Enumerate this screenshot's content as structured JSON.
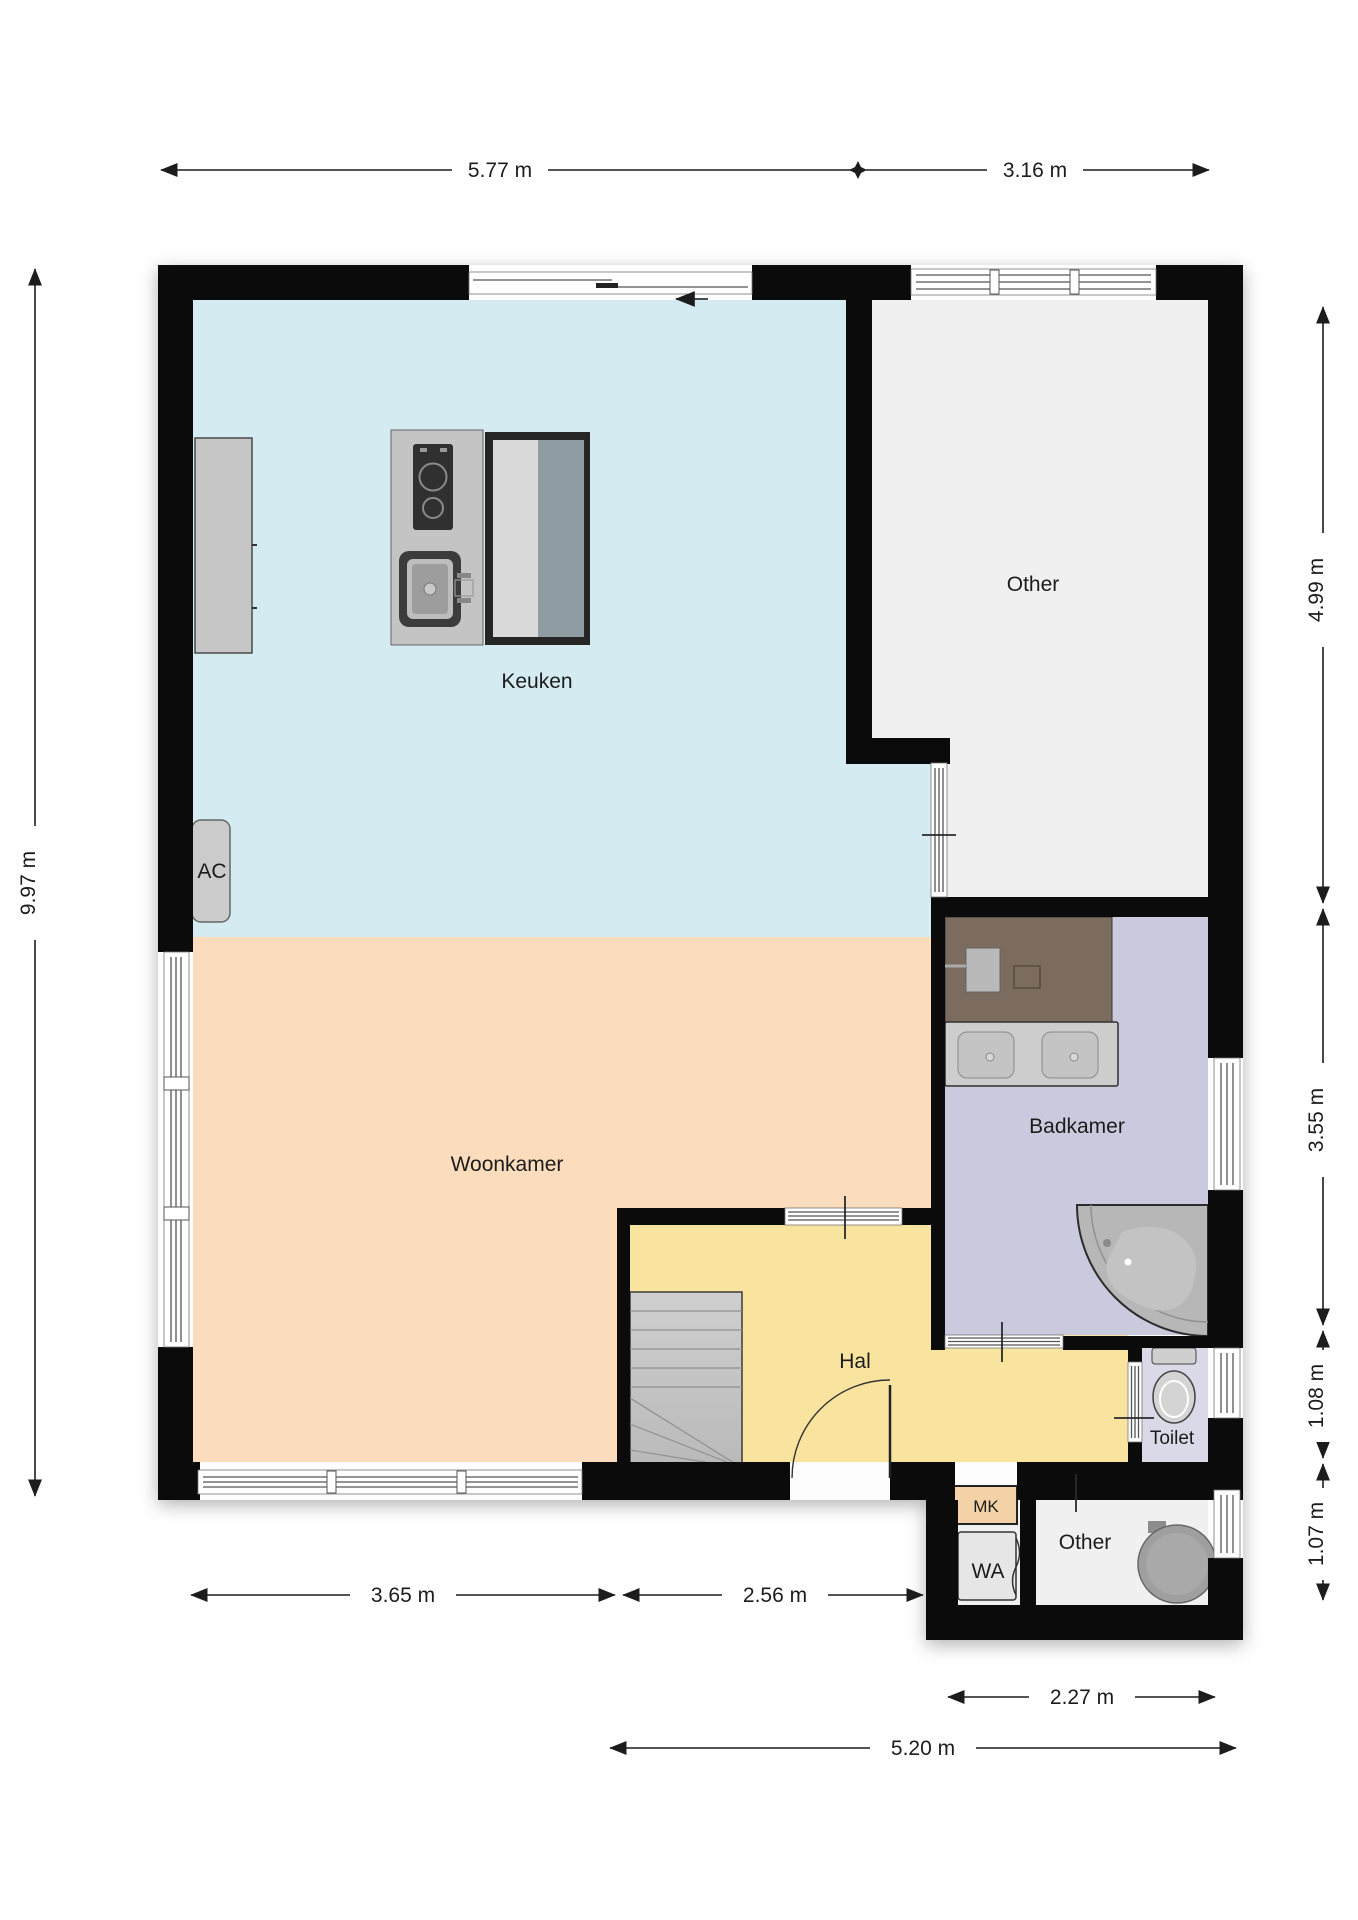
{
  "plan": {
    "rooms": [
      {
        "id": "keuken",
        "label": "Keuken",
        "color": "#d3ebf1"
      },
      {
        "id": "other_top",
        "label": "Other",
        "color": "#f0f0f0"
      },
      {
        "id": "woonkamer",
        "label": "Woonkamer",
        "color": "#fbdcbc"
      },
      {
        "id": "badkamer",
        "label": "Badkamer",
        "color": "#cacade"
      },
      {
        "id": "hal",
        "label": "Hal",
        "color": "#f8e49e"
      },
      {
        "id": "toilet",
        "label": "Toilet",
        "color": "#d9d9e8"
      },
      {
        "id": "mk",
        "label": "MK",
        "color": "#f2d2a6"
      },
      {
        "id": "wa",
        "label": "WA",
        "color": "#e6e6e6"
      },
      {
        "id": "other_bottom",
        "label": "Other",
        "color": "#f0f0f0"
      }
    ],
    "labels": {
      "ac": "AC"
    },
    "dimensions": {
      "top": [
        {
          "label": "5.77 m"
        },
        {
          "label": "3.16 m"
        }
      ],
      "left": [
        {
          "label": "9.97 m"
        }
      ],
      "right": [
        {
          "label": "4.99 m"
        },
        {
          "label": "3.55 m"
        },
        {
          "label": "1.08 m"
        },
        {
          "label": "1.07 m"
        }
      ],
      "bottom": [
        {
          "label": "3.65 m"
        },
        {
          "label": "2.56 m"
        },
        {
          "label": "2.27 m"
        },
        {
          "label": "5.20 m"
        }
      ]
    },
    "fixtures": [
      "kitchen-tall-cabinet",
      "kitchen-island",
      "cooktop",
      "kitchen-sink",
      "kitchen-table",
      "ac-unit",
      "entry-direction-arrow",
      "bathroom-counter",
      "double-washbasin",
      "corner-bath",
      "toilet-bowl",
      "stairs",
      "front-door",
      "boiler",
      "washer-connection",
      "meter-cupboard"
    ],
    "colors": {
      "wall": "#0b0b0b",
      "window_line": "#555555",
      "bath_counter_brown": "#7b6c5f",
      "fixture_gray": "#c4c4c4",
      "table_dark": "#262626",
      "table_blue_gray": "#8f9da3",
      "dim_text": "#1c1c1c"
    }
  }
}
